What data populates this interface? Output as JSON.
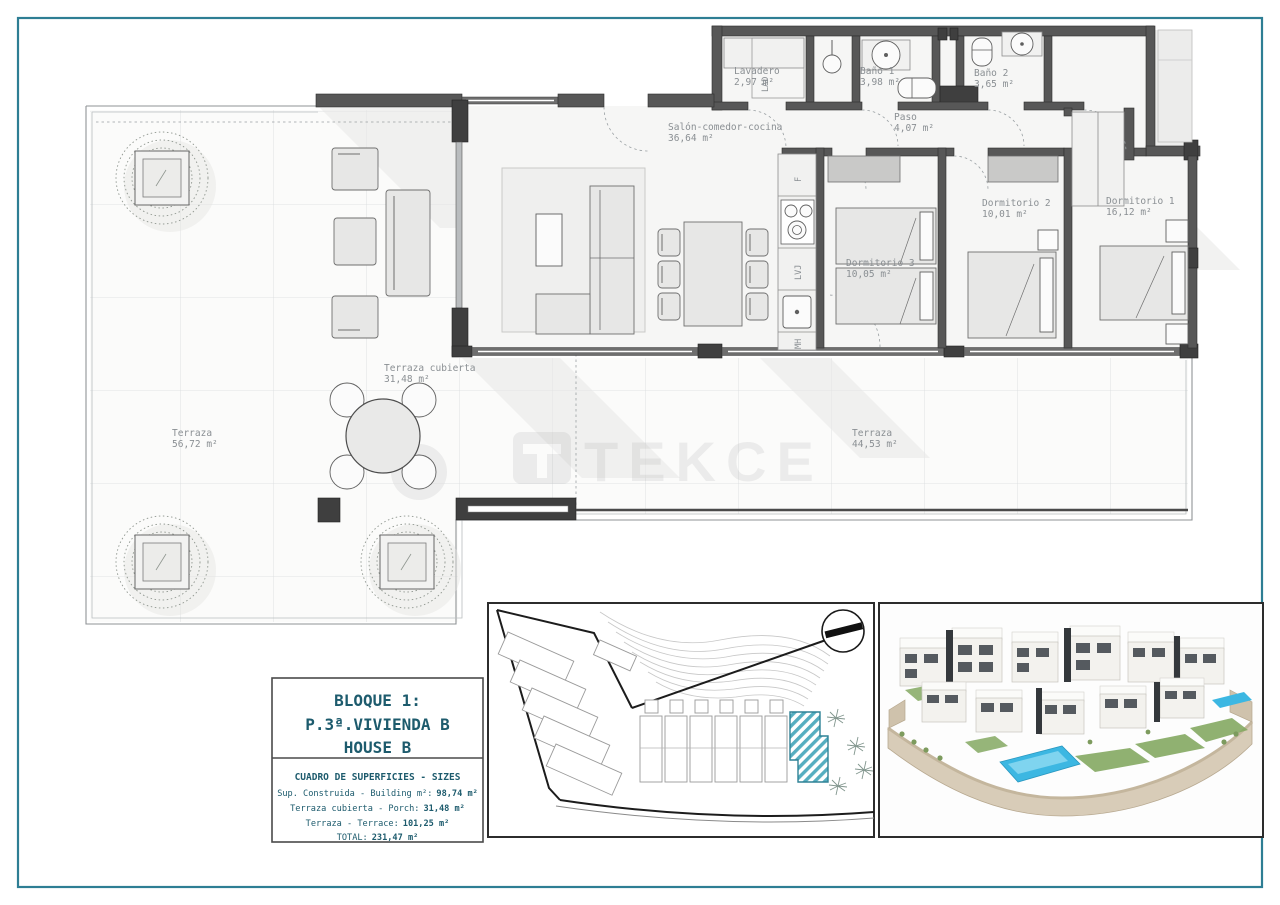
{
  "page": {
    "watermark": "TEKCE",
    "frame_color": "#2e7e94"
  },
  "colors": {
    "frame_teal": "#2e7e94",
    "wall_gray": "#575757",
    "label_gray": "#8a8f93",
    "info_teal": "#1d5b6d",
    "highlight_hatch_teal": "#56aec0",
    "pool_blue": "#3cb7e2",
    "lawn_green": "#84a862",
    "stone_tan": "#d8ccb8"
  },
  "floor_plan": {
    "rooms": [
      {
        "name": "Lavadero",
        "area": "2,97 m²"
      },
      {
        "name": "Baño 1",
        "area": "3,98 m²"
      },
      {
        "name": "Baño 2",
        "area": "3,65 m²"
      },
      {
        "name": "Paso",
        "area": "4,07 m²"
      },
      {
        "name": "Salón-comedor-cocina",
        "area": "36,64 m²"
      },
      {
        "name": "Dormitorio 3",
        "area": "10,05 m²"
      },
      {
        "name": "Dormitorio 2",
        "area": "10,01 m²"
      },
      {
        "name": "Dormitorio 1",
        "area": "16,12 m²"
      },
      {
        "name": "Terraza cubierta",
        "area": "31,48 m²"
      },
      {
        "name": "Terraza",
        "area": "56,72 m²"
      },
      {
        "name": "Terraza",
        "area": "44,53 m²"
      }
    ],
    "appliance_labels": {
      "washer": "LAD",
      "fridge": "F",
      "dishwasher": "LVJ",
      "microwave": "MH"
    }
  },
  "info_box": {
    "block_title": "BLOQUE 1:",
    "unit_title": "P.3ª.VIVIENDA B",
    "house_title": "HOUSE B",
    "table_title": "CUADRO DE SUPERFICIES  -  SIZES",
    "rows": [
      {
        "label": "Sup. Construida - Building m²:",
        "value": "98,74 m²"
      },
      {
        "label": "Terraza cubierta - Porch:",
        "value": "31,48 m²"
      },
      {
        "label": "Terraza - Terrace:",
        "value": "101,25 m²"
      },
      {
        "label": "TOTAL:",
        "value": "231,47 m²"
      }
    ]
  }
}
